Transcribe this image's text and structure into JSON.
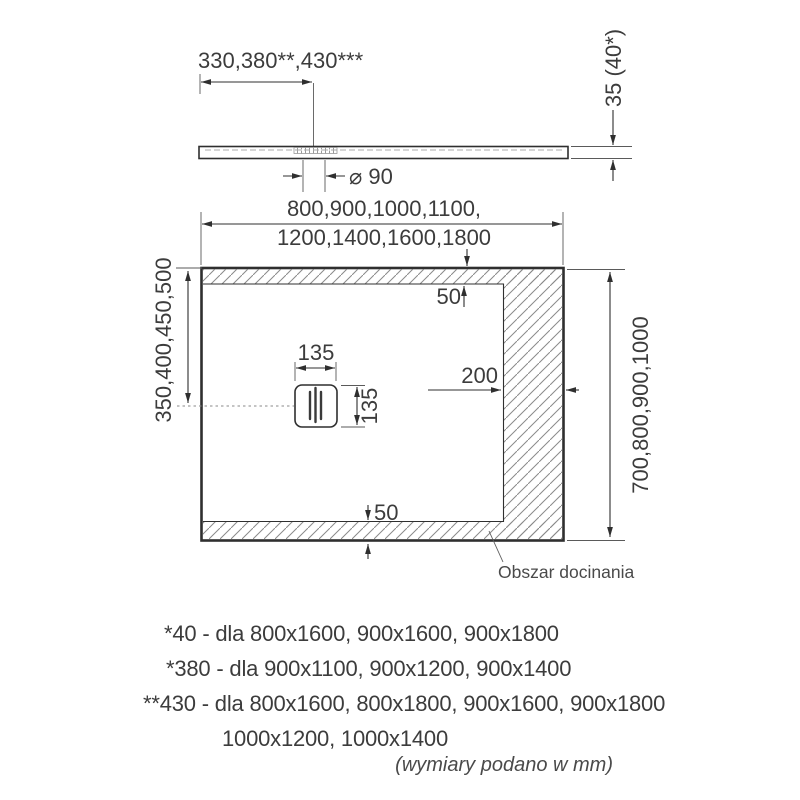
{
  "side_view": {
    "width_label": "330,380**,430***",
    "thickness_label": "35 (40*)",
    "drain_diameter_label": "⌀ 90"
  },
  "top_view": {
    "width_label_line1": "800,900,1000,1100,",
    "width_label_line2": "1200,1400,1600,1800",
    "length_label": "700,800,900,1000",
    "drain_offset_label": "350,400,450,500",
    "drain_width_label": "135",
    "drain_height_label": "135",
    "top_trim_label": "50",
    "bottom_trim_label": "50",
    "right_trim_label": "200",
    "trim_area_label": "Obszar docinania"
  },
  "footnotes": [
    "*40 - dla 800x1600, 900x1600, 900x1800",
    "*380 - dla 900x1100, 900x1200, 900x1400",
    "**430 - dla 800x1600, 800x1800, 900x1600, 900x1800",
    "1000x1200, 1000x1400"
  ],
  "units_note": "(wymiary podano w mm)",
  "colors": {
    "line": "#2f2f2f",
    "text": "#3c3c3c",
    "hatch": "#8a8a8a"
  }
}
